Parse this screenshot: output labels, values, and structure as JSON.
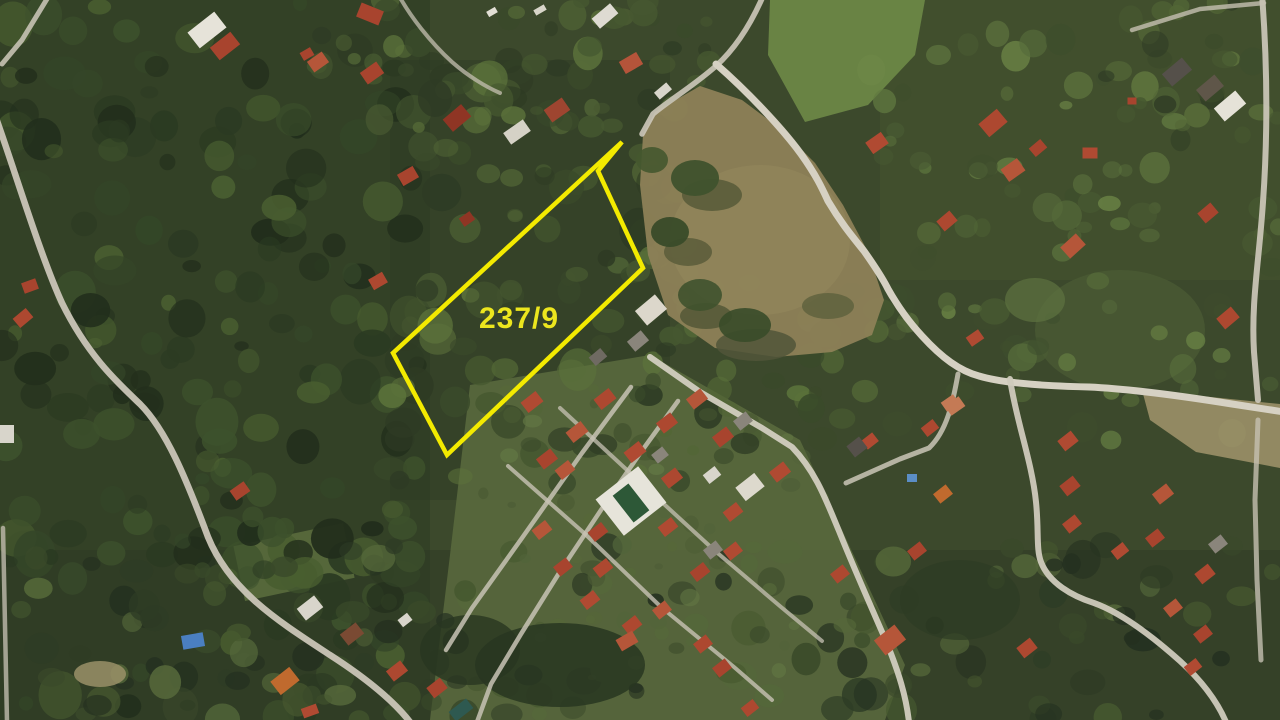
{
  "image": {
    "kind": "aerial-satellite-photo",
    "width": 1280,
    "height": 720
  },
  "parcel": {
    "label": "237/9",
    "label_color": "#ece61e",
    "label_x": 519,
    "label_y": 328,
    "label_font_size": 30,
    "outline_color": "#f3ea00",
    "outline_width": 4.5,
    "points": "622,142 598,171 643,268 447,455 393,353"
  },
  "scene": {
    "base": "#3c492c",
    "palettes": {
      "dark": [
        "#222e1c",
        "#2b3a22",
        "#344628",
        "#3d512c",
        "#495e30"
      ],
      "mid": [
        "#2e3b24",
        "#3a4a2a",
        "#465830",
        "#526636",
        "#5c733b"
      ],
      "light": [
        "#3e4e2d",
        "#4a5c33",
        "#566b3a",
        "#627a41",
        "#6d8747"
      ],
      "lawn": [
        "#4a5a33",
        "#566839",
        "#637844",
        "#52643a"
      ],
      "mixed": [
        "#243020",
        "#2e3c25",
        "#3a4a2a",
        "#46582f",
        "#55683a"
      ]
    },
    "underlays": [
      {
        "t": "poly",
        "p": "0,0 430,0 430,720 0,720",
        "f": "#2b3a22",
        "o": 0.55
      },
      {
        "t": "rect",
        "x": 390,
        "y": 60,
        "w": 280,
        "h": 440,
        "f": "#2e3c24",
        "o": 0.5
      },
      {
        "t": "rect",
        "x": 0,
        "y": 550,
        "w": 1280,
        "h": 170,
        "f": "#2d3a23",
        "o": 0.5
      },
      {
        "t": "rect",
        "x": 880,
        "y": 0,
        "w": 400,
        "h": 280,
        "f": "#46572f",
        "o": 0.45
      },
      {
        "t": "poly",
        "p": "770,0 925,0 915,55 868,105 805,122 768,55",
        "f": "#6e8947",
        "o": 0.9
      },
      {
        "t": "poly",
        "p": "470,385 650,355 800,440 905,665 885,720 430,720 450,555",
        "f": "#5a6b3e",
        "o": 0.85
      },
      {
        "t": "rect",
        "x": 238,
        "y": 534,
        "w": 112,
        "h": 56,
        "rot": -12,
        "f": "#5a6b3d",
        "o": 0.9
      },
      {
        "t": "ell",
        "cx": 1120,
        "cy": 330,
        "rx": 85,
        "ry": 60,
        "f": "#4c5d34",
        "o": 0.7
      }
    ],
    "tree_zones": [
      {
        "x": 0,
        "y": 0,
        "w": 420,
        "h": 720,
        "n": 200,
        "rmin": 7,
        "rmax": 22,
        "omin": 0.5,
        "omax": 0.95,
        "pal": "dark"
      },
      {
        "x": 390,
        "y": 60,
        "w": 290,
        "h": 430,
        "n": 100,
        "rmin": 7,
        "rmax": 20,
        "omin": 0.5,
        "omax": 0.9,
        "pal": "mid"
      },
      {
        "x": 290,
        "y": 0,
        "w": 420,
        "h": 130,
        "n": 45,
        "rmin": 6,
        "rmax": 16,
        "omin": 0.5,
        "omax": 0.9,
        "pal": "mid"
      },
      {
        "x": 870,
        "y": 30,
        "w": 410,
        "h": 420,
        "n": 90,
        "rmin": 6,
        "rmax": 16,
        "omin": 0.4,
        "omax": 0.8,
        "pal": "light"
      },
      {
        "x": 630,
        "y": 270,
        "w": 260,
        "h": 190,
        "n": 45,
        "rmin": 6,
        "rmax": 16,
        "omin": 0.5,
        "omax": 0.9,
        "pal": "mid"
      },
      {
        "x": 0,
        "y": 545,
        "w": 1280,
        "h": 175,
        "n": 150,
        "rmin": 7,
        "rmax": 18,
        "omin": 0.5,
        "omax": 0.9,
        "pal": "mixed"
      },
      {
        "x": 470,
        "y": 380,
        "w": 360,
        "h": 300,
        "n": 45,
        "rmin": 4,
        "rmax": 10,
        "omin": 0.4,
        "omax": 0.75,
        "pal": "lawn"
      },
      {
        "x": 1100,
        "y": 0,
        "w": 180,
        "h": 140,
        "n": 25,
        "rmin": 6,
        "rmax": 14,
        "omin": 0.5,
        "omax": 0.85,
        "pal": "mid"
      }
    ],
    "overlays": [
      {
        "t": "poly",
        "p": "655,112 700,86 742,100 782,130 815,163 843,205 868,252 884,300 872,335 832,352 776,357 715,348 668,315 648,255 640,185 643,135",
        "f": "#8d8157",
        "o": 0.95
      },
      {
        "t": "ell",
        "cx": 760,
        "cy": 240,
        "rx": 90,
        "ry": 75,
        "f": "#968a5e",
        "o": 0.5
      },
      {
        "t": "ell",
        "cx": 712,
        "cy": 195,
        "rx": 30,
        "ry": 16,
        "f": "#5a5c3a",
        "o": 0.9
      },
      {
        "t": "ell",
        "cx": 688,
        "cy": 252,
        "rx": 24,
        "ry": 14,
        "f": "#5a5c3a",
        "o": 0.85
      },
      {
        "t": "ell",
        "cx": 706,
        "cy": 316,
        "rx": 26,
        "ry": 13,
        "f": "#565a38",
        "o": 0.9
      },
      {
        "t": "ell",
        "cx": 756,
        "cy": 345,
        "rx": 40,
        "ry": 16,
        "f": "#51553a",
        "o": 0.85
      },
      {
        "t": "ell",
        "cx": 828,
        "cy": 306,
        "rx": 26,
        "ry": 13,
        "f": "#5d603c",
        "o": 0.8
      },
      {
        "t": "ell",
        "cx": 695,
        "cy": 178,
        "rx": 24,
        "ry": 18,
        "f": "#3f522d",
        "o": 0.95
      },
      {
        "t": "ell",
        "cx": 670,
        "cy": 232,
        "rx": 19,
        "ry": 15,
        "f": "#394b29",
        "o": 0.95
      },
      {
        "t": "ell",
        "cx": 700,
        "cy": 295,
        "rx": 22,
        "ry": 16,
        "f": "#3f522d",
        "o": 0.9
      },
      {
        "t": "ell",
        "cx": 745,
        "cy": 325,
        "rx": 26,
        "ry": 17,
        "f": "#394b29",
        "o": 0.9
      },
      {
        "t": "ell",
        "cx": 652,
        "cy": 160,
        "rx": 16,
        "ry": 13,
        "f": "#45582f",
        "o": 0.9
      },
      {
        "t": "poly",
        "p": "1142,390 1280,404 1280,468 1196,452 1150,420",
        "f": "#9b9068",
        "o": 0.9
      },
      {
        "t": "ell",
        "cx": 100,
        "cy": 674,
        "rx": 26,
        "ry": 13,
        "f": "#9a9069",
        "o": 0.85
      },
      {
        "t": "ell",
        "cx": 560,
        "cy": 665,
        "rx": 85,
        "ry": 42,
        "f": "#283621",
        "o": 0.85
      },
      {
        "t": "ell",
        "cx": 470,
        "cy": 650,
        "rx": 50,
        "ry": 35,
        "f": "#283621",
        "o": 0.8
      },
      {
        "t": "ell",
        "cx": 960,
        "cy": 600,
        "rx": 60,
        "ry": 40,
        "f": "#2e3c24",
        "o": 0.7
      },
      {
        "t": "ell",
        "cx": 1035,
        "cy": 300,
        "rx": 30,
        "ry": 22,
        "f": "#5e7440",
        "o": 0.7
      }
    ],
    "roads": [
      [
        "M 50,-6 L 22,40 L 2,64",
        5,
        "#c7c2b4",
        0.9
      ],
      [
        "M -4,118 C 14,168 40,255 62,303 C 88,356 118,383 140,404 C 166,430 186,478 208,537 C 230,591 278,621 330,655 C 372,682 396,704 410,722",
        6.5,
        "#cac5b7",
        0.95
      ],
      [
        "M 3,528 L 7,722",
        4.5,
        "#c0bbae",
        0.8
      ],
      [
        "M 398,-6 C 410,16 430,42 452,62 C 468,76 486,87 500,93",
        4,
        "#c5c0b2",
        0.75
      ],
      [
        "M 764,-6 C 752,22 737,47 716,66 C 692,87 668,101 653,114 L 642,134",
        5.5,
        "#cdc8ba",
        0.9
      ],
      [
        "M 716,64 C 748,92 782,128 801,154 C 816,175 822,188 828,201 C 841,223 852,236 864,251 C 876,268 883,279 888,289 C 897,305 907,320 922,336 C 942,358 960,371 979,376 C 1002,383 1042,386 1089,387 C 1132,389 1182,396 1232,404 L 1284,412",
        7,
        "#d6d1c3",
        1
      ],
      [
        "M 1010,379 C 1016,420 1032,462 1036,502 C 1039,531 1036,549 1041,562 C 1049,583 1072,596 1094,603 C 1122,613 1152,636 1180,661 C 1202,681 1217,701 1226,722",
        6,
        "#cfcabc",
        0.95
      ],
      [
        "M 1262,-6 C 1267,60 1268,132 1263,202 C 1259,262 1251,302 1254,352 L 1258,400",
        6,
        "#cfcabc",
        0.9
      ],
      [
        "M 1258,420 L 1255,500 L 1257,580 L 1261,660",
        5,
        "#c5c0b2",
        0.8
      ],
      [
        "M 1132,30 L 1200,9 L 1264,3",
        4.5,
        "#c5c0b2",
        0.8
      ],
      [
        "M 650,357 L 700,392 L 762,428 L 792,447 C 816,472 826,500 839,531 C 853,566 869,602 886,641 C 899,673 906,696 909,722",
        6,
        "#d2cdbf",
        0.95
      ],
      [
        "M 631,387 L 582,453 L 522,538 L 472,608 L 446,650",
        4.5,
        "#c8c3b5",
        0.85
      ],
      [
        "M 678,401 L 641,452 L 601,510 L 561,570 L 521,634 L 491,684 L 477,722",
        4.5,
        "#c8c3b5",
        0.85
      ],
      [
        "M 508,466 L 584,533 L 661,607 L 734,667 L 772,700",
        4,
        "#c8c3b5",
        0.8
      ],
      [
        "M 560,408 L 641,483 L 714,550 L 781,607 L 822,641",
        4,
        "#c8c3b5",
        0.75
      ],
      [
        "M 846,483 L 900,459 L 929,448 C 947,431 953,402 958,374",
        5,
        "#cac5b7",
        0.85
      ]
    ],
    "pool": {
      "deck": {
        "cx": 631,
        "cy": 501,
        "w": 54,
        "h": 46,
        "rot": -38,
        "f": "#e6e4da"
      },
      "water": {
        "cx": 631,
        "cy": 503,
        "w": 20,
        "h": 34,
        "rot": -38,
        "f": "#2d5837"
      }
    },
    "buildings": [
      [
        207,
        30,
        34,
        20,
        -38,
        "#e6e3d9"
      ],
      [
        225,
        46,
        26,
        16,
        -38,
        "#a8442e"
      ],
      [
        307,
        54,
        12,
        9,
        -30,
        "#a8442e"
      ],
      [
        370,
        14,
        24,
        15,
        22,
        "#a8442e"
      ],
      [
        318,
        62,
        18,
        13,
        -35,
        "#b55639"
      ],
      [
        372,
        73,
        20,
        14,
        -35,
        "#a8442e"
      ],
      [
        457,
        118,
        24,
        16,
        -40,
        "#8f3524"
      ],
      [
        557,
        110,
        22,
        15,
        -35,
        "#9e4530"
      ],
      [
        605,
        16,
        24,
        13,
        -40,
        "#dedbd2"
      ],
      [
        631,
        63,
        20,
        14,
        -30,
        "#b5543a"
      ],
      [
        663,
        91,
        16,
        9,
        -40,
        "#d8d5cb"
      ],
      [
        517,
        132,
        24,
        14,
        -35,
        "#d5d2c6"
      ],
      [
        408,
        176,
        18,
        13,
        -30,
        "#a8442e"
      ],
      [
        492,
        12,
        10,
        6,
        -30,
        "#e2dfd5"
      ],
      [
        540,
        10,
        12,
        6,
        -30,
        "#d8d5c9"
      ],
      [
        877,
        143,
        19,
        14,
        -35,
        "#b04a32"
      ],
      [
        993,
        123,
        24,
        17,
        -40,
        "#ad4830"
      ],
      [
        1013,
        170,
        20,
        15,
        -35,
        "#b55639"
      ],
      [
        1038,
        148,
        15,
        11,
        -40,
        "#a8442e"
      ],
      [
        1090,
        153,
        15,
        11,
        0,
        "#b04a32"
      ],
      [
        947,
        221,
        17,
        13,
        -40,
        "#ad4830"
      ],
      [
        1073,
        246,
        21,
        15,
        -42,
        "#b55639"
      ],
      [
        1208,
        213,
        17,
        13,
        -40,
        "#a8442e"
      ],
      [
        1228,
        318,
        19,
        14,
        -40,
        "#ad4830"
      ],
      [
        975,
        338,
        15,
        11,
        -35,
        "#b04a32"
      ],
      [
        955,
        406,
        17,
        12,
        -35,
        "#c47a55"
      ],
      [
        1177,
        72,
        26,
        16,
        -40,
        "#55504a"
      ],
      [
        1210,
        88,
        24,
        15,
        -40,
        "#5f5649"
      ],
      [
        1230,
        106,
        28,
        17,
        -40,
        "#e5e2d8"
      ],
      [
        1132,
        101,
        9,
        7,
        0,
        "#a8442e"
      ],
      [
        30,
        286,
        15,
        11,
        -20,
        "#a8442e"
      ],
      [
        23,
        318,
        17,
        12,
        -40,
        "#ad4830"
      ],
      [
        7,
        434,
        14,
        18,
        0,
        "#d8d5cb"
      ],
      [
        240,
        491,
        17,
        12,
        -35,
        "#a8442e"
      ],
      [
        378,
        281,
        16,
        12,
        -30,
        "#ad4830"
      ],
      [
        467,
        219,
        13,
        10,
        -35,
        "#8f3524"
      ],
      [
        651,
        310,
        26,
        19,
        -40,
        "#dcd7cb"
      ],
      [
        638,
        341,
        18,
        13,
        -40,
        "#8a857b"
      ],
      [
        598,
        357,
        15,
        11,
        -40,
        "#6f6a62"
      ],
      [
        532,
        402,
        19,
        13,
        -38,
        "#b04a32"
      ],
      [
        605,
        399,
        19,
        13,
        -38,
        "#ad4830"
      ],
      [
        577,
        432,
        19,
        13,
        -38,
        "#b55639"
      ],
      [
        547,
        459,
        18,
        13,
        -38,
        "#a8442e"
      ],
      [
        635,
        452,
        19,
        13,
        -38,
        "#b04a32"
      ],
      [
        667,
        423,
        18,
        13,
        -38,
        "#ad4830"
      ],
      [
        697,
        399,
        18,
        13,
        -38,
        "#b55639"
      ],
      [
        723,
        437,
        18,
        13,
        -38,
        "#a8442e"
      ],
      [
        743,
        421,
        16,
        12,
        -38,
        "#8a857b"
      ],
      [
        780,
        472,
        18,
        13,
        -38,
        "#b04a32"
      ],
      [
        672,
        478,
        18,
        13,
        -38,
        "#ad4830"
      ],
      [
        565,
        470,
        17,
        12,
        -38,
        "#b55639"
      ],
      [
        598,
        532,
        17,
        12,
        -38,
        "#a8442e"
      ],
      [
        668,
        527,
        17,
        12,
        -38,
        "#b04a32"
      ],
      [
        603,
        568,
        17,
        12,
        -38,
        "#ad4830"
      ],
      [
        542,
        530,
        17,
        12,
        -38,
        "#b55639"
      ],
      [
        563,
        567,
        16,
        12,
        -38,
        "#a8442e"
      ],
      [
        590,
        600,
        17,
        12,
        -38,
        "#b04a32"
      ],
      [
        632,
        625,
        17,
        12,
        -38,
        "#ad4830"
      ],
      [
        662,
        610,
        16,
        12,
        -38,
        "#b55639"
      ],
      [
        700,
        572,
        17,
        12,
        -38,
        "#a8442e"
      ],
      [
        713,
        550,
        16,
        12,
        -38,
        "#8a857b"
      ],
      [
        733,
        512,
        17,
        12,
        -38,
        "#b04a32"
      ],
      [
        750,
        487,
        24,
        17,
        -38,
        "#ddd9cd"
      ],
      [
        712,
        475,
        15,
        11,
        -38,
        "#d8d5cb"
      ],
      [
        660,
        455,
        14,
        11,
        -38,
        "#8a857b"
      ],
      [
        193,
        641,
        22,
        14,
        -10,
        "#4a7fc1"
      ],
      [
        310,
        608,
        22,
        15,
        -38,
        "#d8d5cb"
      ],
      [
        352,
        634,
        20,
        14,
        -38,
        "#7a4a33"
      ],
      [
        285,
        681,
        24,
        17,
        -38,
        "#c06a2e"
      ],
      [
        397,
        671,
        18,
        13,
        -38,
        "#ad4830"
      ],
      [
        437,
        688,
        17,
        13,
        -38,
        "#a8442e"
      ],
      [
        461,
        710,
        22,
        12,
        -38,
        "#2e5950"
      ],
      [
        310,
        711,
        16,
        10,
        -20,
        "#b04a32"
      ],
      [
        405,
        620,
        12,
        9,
        -38,
        "#d8d5cb"
      ],
      [
        627,
        641,
        19,
        13,
        -30,
        "#b55639"
      ],
      [
        703,
        644,
        16,
        12,
        -38,
        "#ad4830"
      ],
      [
        722,
        668,
        16,
        12,
        -38,
        "#a8442e"
      ],
      [
        733,
        551,
        16,
        12,
        -38,
        "#b04a32"
      ],
      [
        840,
        574,
        16,
        12,
        -38,
        "#ad4830"
      ],
      [
        917,
        551,
        16,
        12,
        -38,
        "#a8442e"
      ],
      [
        890,
        640,
        26,
        19,
        -38,
        "#b55639"
      ],
      [
        1027,
        648,
        17,
        13,
        -38,
        "#ad4830"
      ],
      [
        1068,
        441,
        17,
        13,
        -38,
        "#b04a32"
      ],
      [
        1070,
        486,
        17,
        13,
        -38,
        "#a8442e"
      ],
      [
        1072,
        524,
        16,
        12,
        -38,
        "#ad4830"
      ],
      [
        1163,
        494,
        18,
        13,
        -38,
        "#b55639"
      ],
      [
        1155,
        538,
        16,
        12,
        -38,
        "#a8442e"
      ],
      [
        1120,
        551,
        15,
        11,
        -38,
        "#b04a32"
      ],
      [
        1205,
        574,
        17,
        13,
        -38,
        "#ad4830"
      ],
      [
        1218,
        544,
        16,
        12,
        -38,
        "#8a857b"
      ],
      [
        1173,
        608,
        16,
        12,
        -38,
        "#b55639"
      ],
      [
        1203,
        634,
        16,
        12,
        -38,
        "#a8442e"
      ],
      [
        750,
        708,
        15,
        11,
        -38,
        "#ad4830"
      ],
      [
        870,
        441,
        14,
        11,
        -38,
        "#b04a32"
      ],
      [
        857,
        447,
        16,
        14,
        -38,
        "#55504a"
      ],
      [
        930,
        428,
        15,
        11,
        -38,
        "#ad4830"
      ],
      [
        950,
        403,
        15,
        11,
        -35,
        "#c47a55"
      ],
      [
        943,
        494,
        16,
        12,
        -38,
        "#c06a2e"
      ],
      [
        1193,
        667,
        15,
        11,
        -38,
        "#b04a32"
      ],
      [
        912,
        478,
        10,
        8,
        0,
        "#5b8ec6"
      ]
    ]
  }
}
